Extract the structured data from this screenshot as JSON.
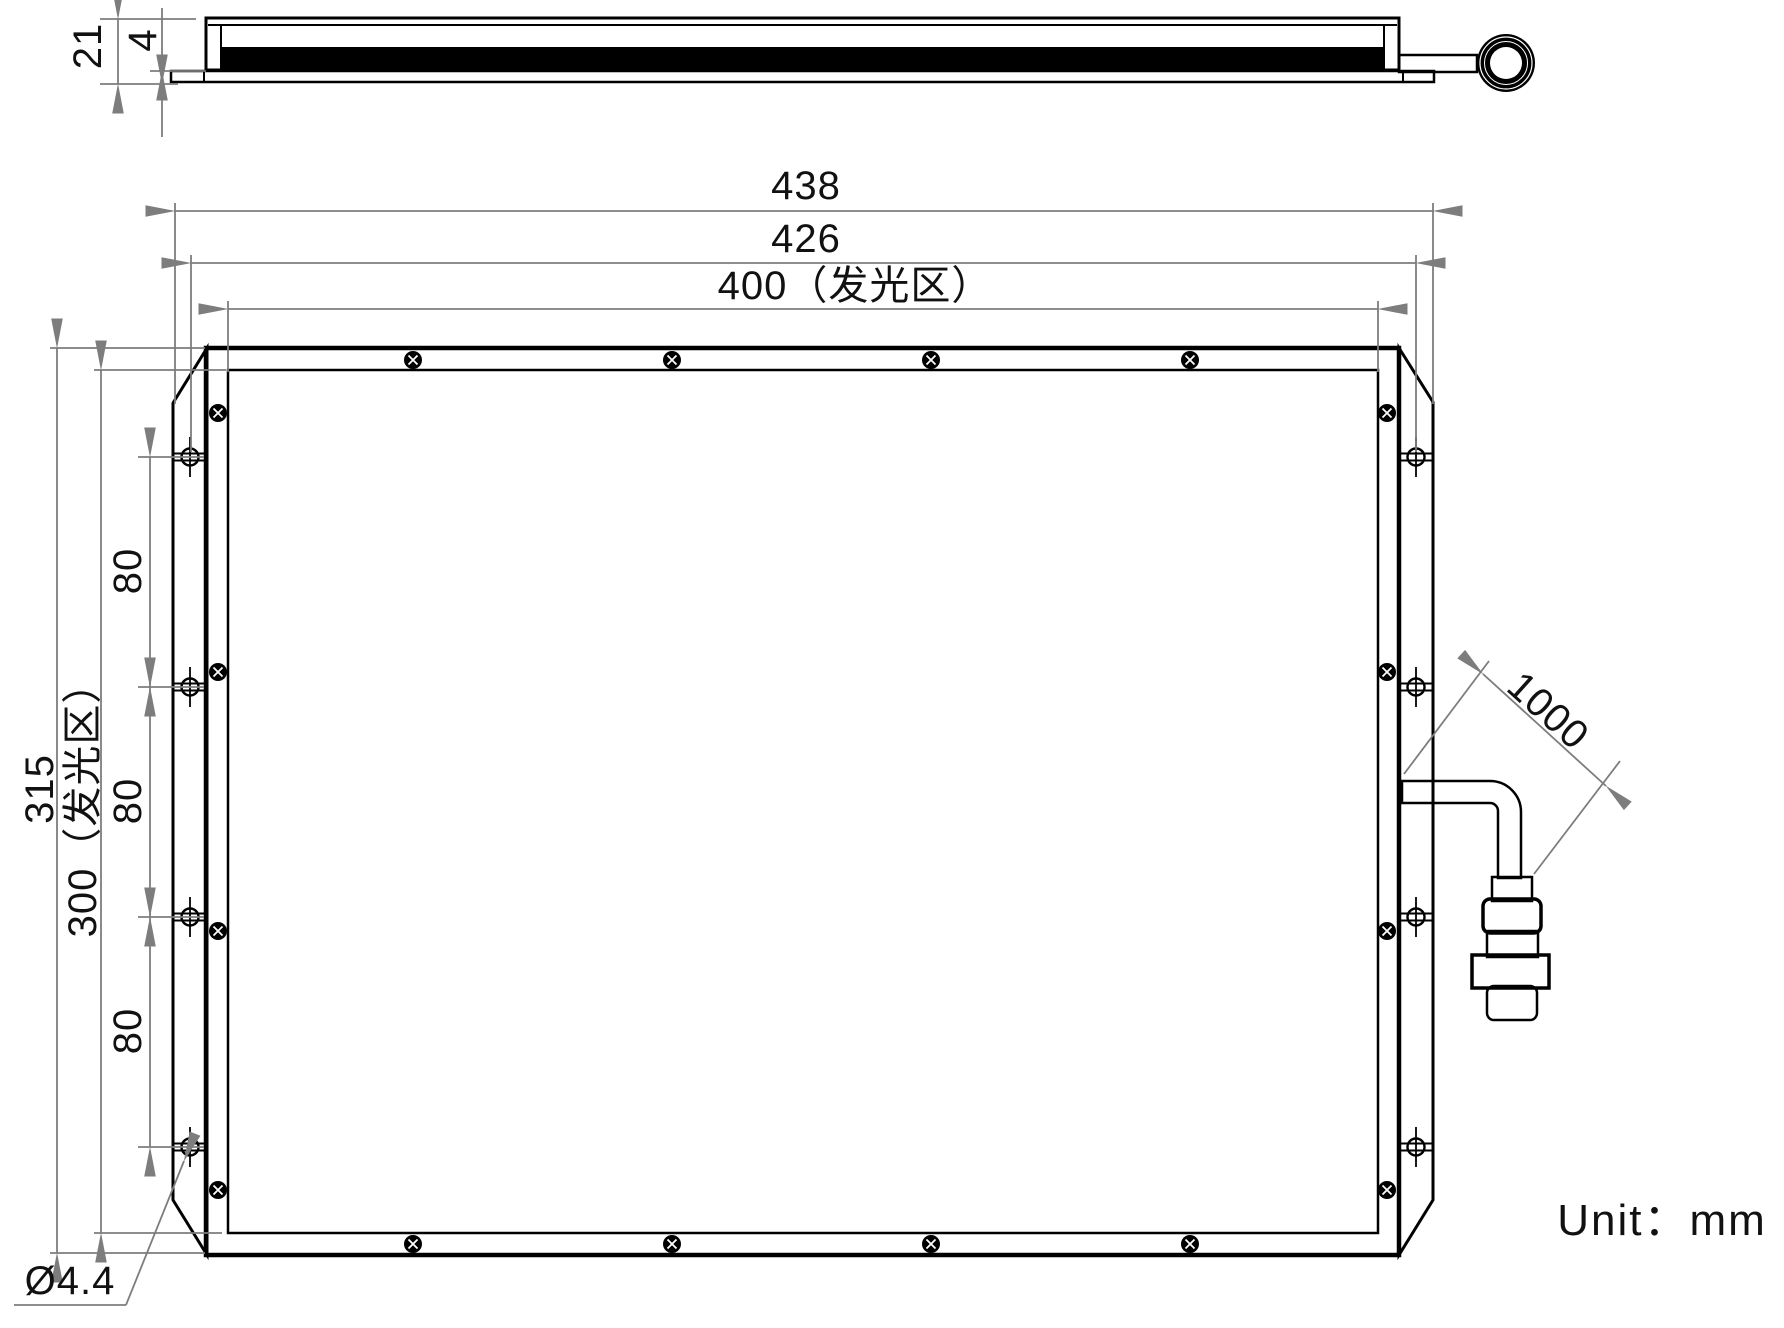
{
  "unit_note": "Unit：mm",
  "side_view": {
    "overall_thickness": "21",
    "flange_thickness": "4"
  },
  "front_view": {
    "overall_width": "438",
    "mounting_hole_width": "426",
    "emitting_width": "400（发光区）",
    "overall_height": "315",
    "emitting_height": "300（发光区）",
    "hole_pitches": [
      "80",
      "80",
      "80"
    ],
    "hole_diameter": "Ø4.4",
    "cable_length": "1000"
  }
}
